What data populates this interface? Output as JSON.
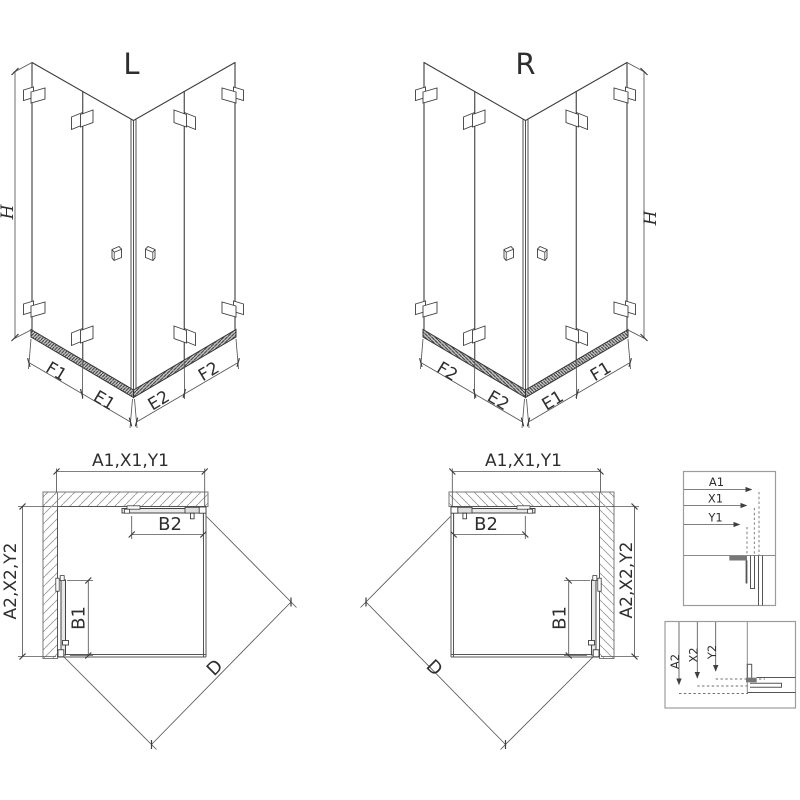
{
  "left_view": {
    "title": "L",
    "h": "H",
    "f1": "F1",
    "e1": "E1",
    "e2": "E2",
    "f2": "F2"
  },
  "right_view": {
    "title": "R",
    "h": "H",
    "f1": "F1",
    "e1": "E1",
    "e2": "E2",
    "f2": "F2"
  },
  "plan_left": {
    "width": "A1,X1,Y1",
    "depth": "A2,X2,Y2",
    "b2": "B2",
    "b1": "B1",
    "d": "D"
  },
  "plan_right": {
    "width": "A1,X1,Y1",
    "depth": "A2,X2,Y2",
    "b2": "B2",
    "b1": "B1",
    "d": "D"
  },
  "detail_top": {
    "a1": "A1",
    "x1": "X1",
    "y1": "Y1"
  },
  "detail_bottom": {
    "a2": "A2",
    "x2": "X2",
    "y2": "Y2"
  },
  "colors": {
    "line": "#3d3d3d",
    "dim": "#555555",
    "wall_hatch": "#9a9a9a",
    "rail": "#333333",
    "box_border": "#9c9c9c",
    "text": "#2e2e2e",
    "background": "#ffffff"
  }
}
